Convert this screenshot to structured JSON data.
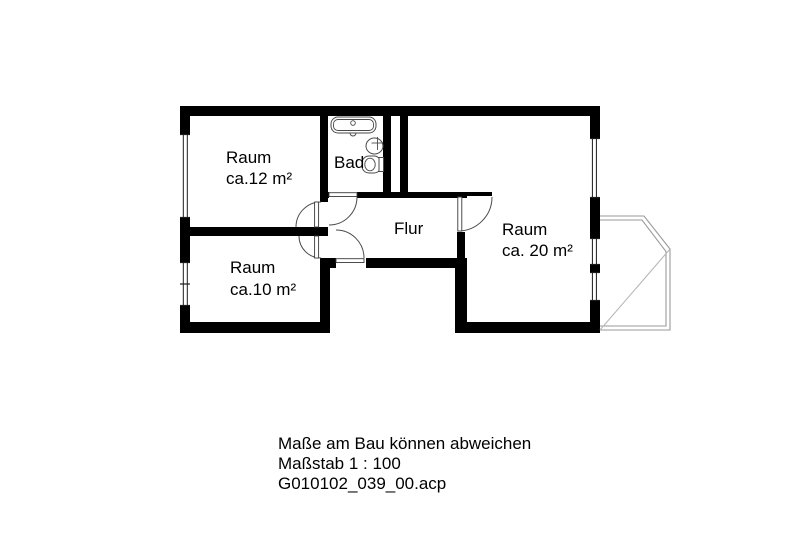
{
  "meta": {
    "type": "floor-plan",
    "colors": {
      "wall": "#000000",
      "text": "#000000",
      "balcony_outline": "#9a9a9a",
      "fixture_outline": "#4a4a4a",
      "background": "#ffffff"
    }
  },
  "rooms": {
    "room12": {
      "name": "Raum",
      "area": "ca.12 m²"
    },
    "room10": {
      "name": "Raum",
      "area": "ca.10 m²"
    },
    "room20": {
      "name": "Raum",
      "area": "ca. 20 m²"
    },
    "bad": {
      "name": "Bad"
    },
    "flur": {
      "name": "Flur"
    }
  },
  "fixtures": {
    "bathtub": "bathtub-icon",
    "sink": "sink-icon",
    "toilet": "toilet-icon",
    "balcony": "balcony-outline"
  },
  "footer": {
    "disclaimer": "Maße am Bau können abweichen",
    "scale": "Maßstab 1 : 100",
    "filename": "G010102_039_00.acp"
  }
}
